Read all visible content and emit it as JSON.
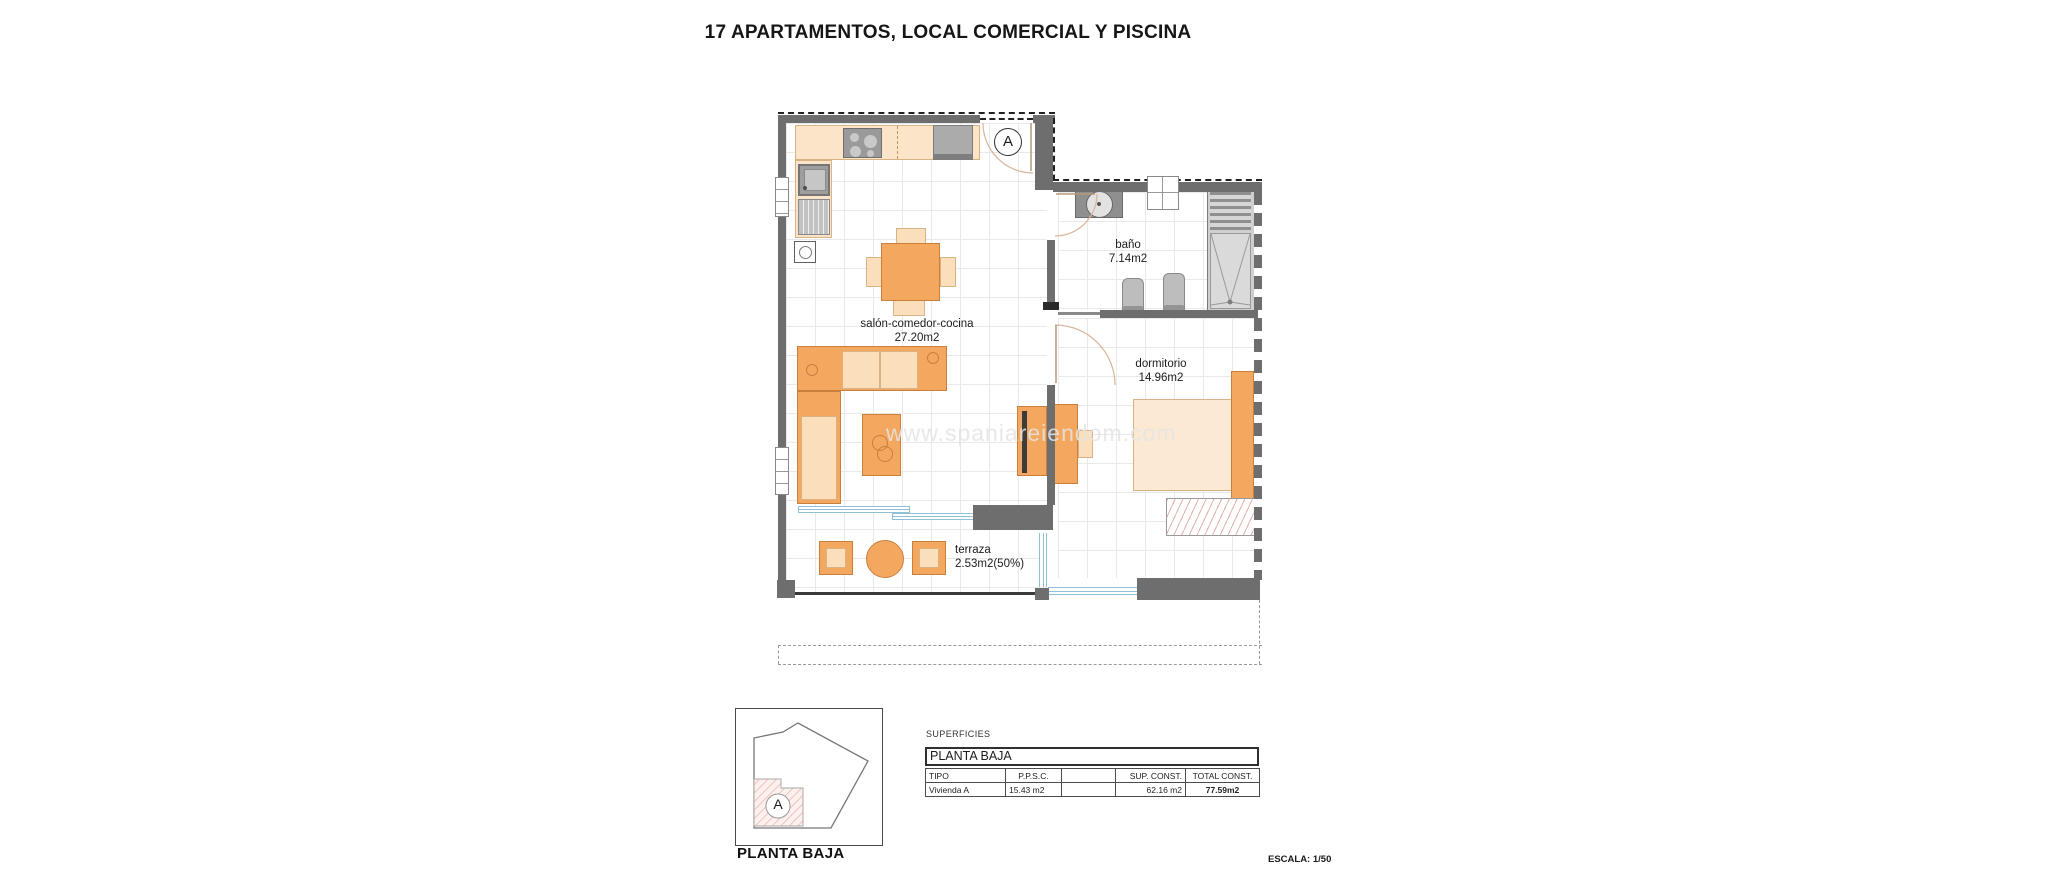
{
  "title": "17 APARTAMENTOS, LOCAL COMERCIAL Y PISCINA",
  "watermark": "www.spaniareiendom.com",
  "plan": {
    "unit_label": "A",
    "rooms": [
      {
        "name": "salón-comedor-cocina",
        "area": "27.20m2"
      },
      {
        "name": "baño",
        "area": "7.14m2"
      },
      {
        "name": "dormitorio",
        "area": "14.96m2"
      },
      {
        "name": "terraza",
        "area": "2.53m2(50%)"
      }
    ]
  },
  "legend": {
    "unit_label": "A",
    "caption": "PLANTA BAJA"
  },
  "surfaces": {
    "section_label": "SUPERFICIES",
    "floor_label": "PLANTA BAJA",
    "columns": [
      "TIPO",
      "P.P.S.C.",
      "",
      "SUP. CONST.",
      "TOTAL CONST."
    ],
    "rows": [
      [
        "Vivienda A",
        "15.43 m2",
        "",
        "62.16 m2",
        "77.59m2"
      ]
    ],
    "scale_label": "ESCALA: 1/50"
  },
  "colors": {
    "wall": "#6e6e6e",
    "furniture_orange": "#f3a75f",
    "furniture_light": "#fbdfba",
    "glass_blue": "#8fc0d8"
  }
}
